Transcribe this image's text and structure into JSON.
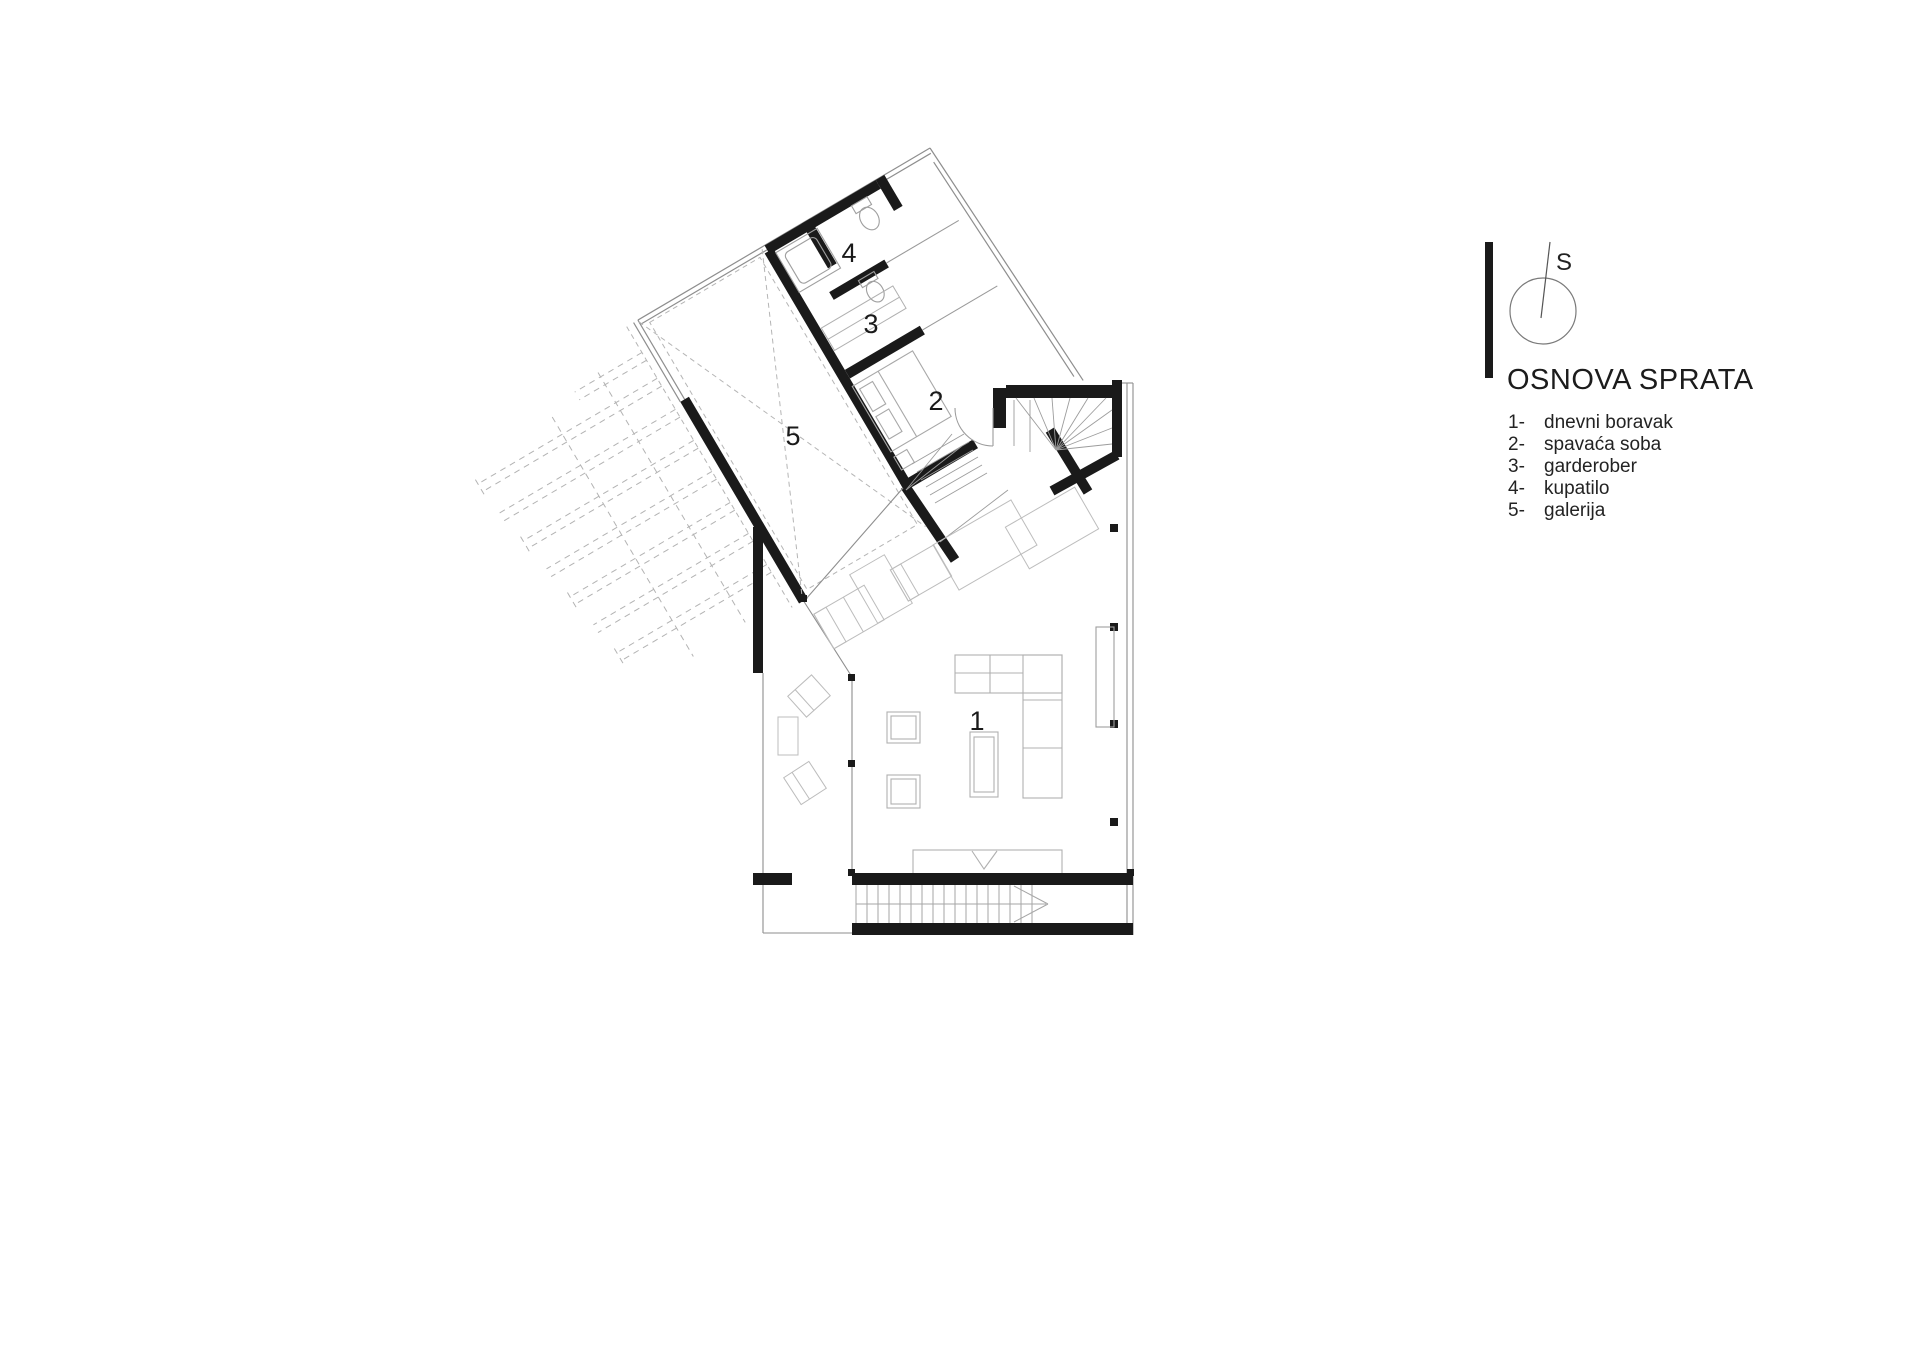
{
  "header": {
    "north_label": "S",
    "title": "OSNOVA SPRATA"
  },
  "legend": {
    "items": [
      {
        "n": "1-",
        "label": "dnevni boravak"
      },
      {
        "n": "2-",
        "label": "spavaća soba"
      },
      {
        "n": "3-",
        "label": "garderober"
      },
      {
        "n": "4-",
        "label": "kupatilo"
      },
      {
        "n": "5-",
        "label": "galerija"
      }
    ]
  },
  "plan": {
    "room_labels": {
      "r1": "1",
      "r2": "2",
      "r3": "3",
      "r4": "4",
      "r5": "5"
    }
  }
}
